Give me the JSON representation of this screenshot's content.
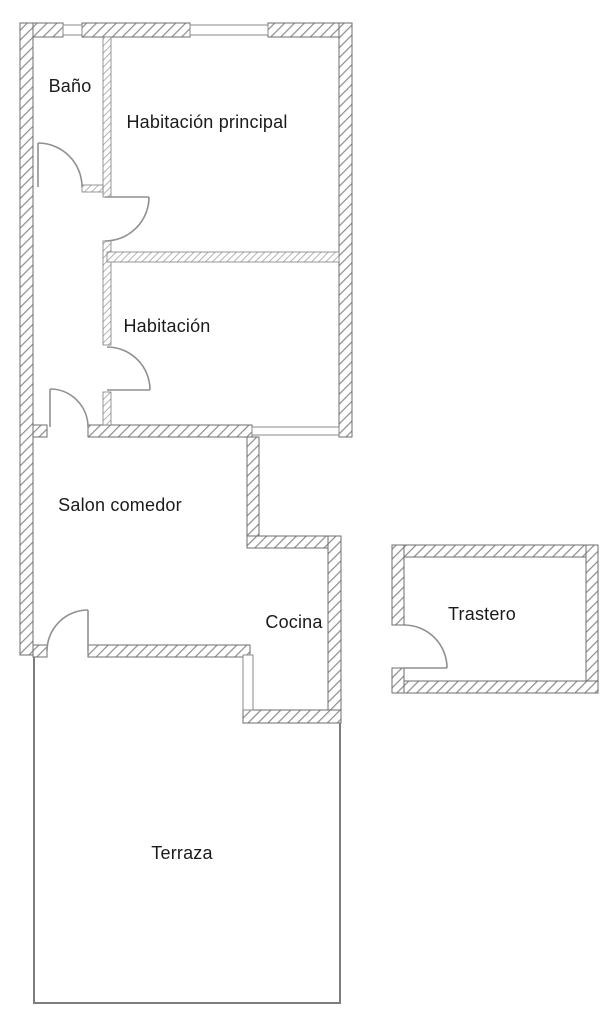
{
  "figure": {
    "type": "floor-plan",
    "language": "es",
    "background": "#ffffff"
  },
  "colors": {
    "wall_outline": "#6e6e6e",
    "exterior_hatch": "#8d8d8d",
    "interior_hatch": "#a6a6a6",
    "door_arc": "#909090",
    "terrace_line": "#7d7d7d",
    "label_text": "#1b1b1b"
  },
  "rooms": [
    {
      "id": "bano",
      "label": "Baño"
    },
    {
      "id": "habitacion-principal",
      "label": "Habitación principal"
    },
    {
      "id": "habitacion",
      "label": "Habitación"
    },
    {
      "id": "salon-comedor",
      "label": "Salon comedor"
    },
    {
      "id": "cocina",
      "label": "Cocina"
    },
    {
      "id": "trastero",
      "label": "Trastero"
    },
    {
      "id": "terraza",
      "label": "Terraza"
    }
  ]
}
